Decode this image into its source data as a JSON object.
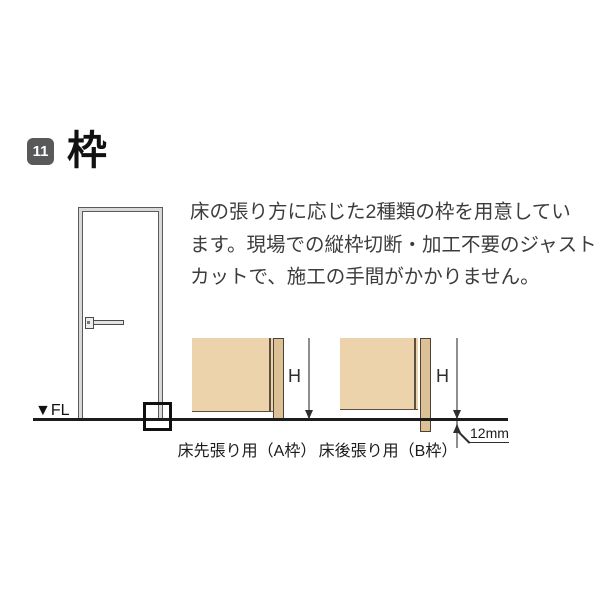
{
  "header": {
    "badge": "11",
    "title": "枠"
  },
  "description": {
    "lines": [
      "床の張り方に応じた2種類の枠を用意してい",
      "ます。現場での縦枠切断・加工不要のジャスト",
      "カットで、施工の手間がかかりません。"
    ]
  },
  "floor": {
    "fl_label": "▼FL"
  },
  "diagrams": {
    "a": {
      "h_label": "H",
      "caption": "床先張り用（A枠）"
    },
    "b": {
      "h_label": "H",
      "caption": "床後張り用（B枠）",
      "offset_label": "12mm"
    }
  },
  "colors": {
    "badge_bg": "#58595b",
    "wall_fill": "#ecd3ab",
    "frame_fill": "#dcc096",
    "outline": "#4d4236",
    "floor_line": "#1c1c1c",
    "dim_line": "#8e8e8e",
    "text": "#3c3c3c"
  }
}
